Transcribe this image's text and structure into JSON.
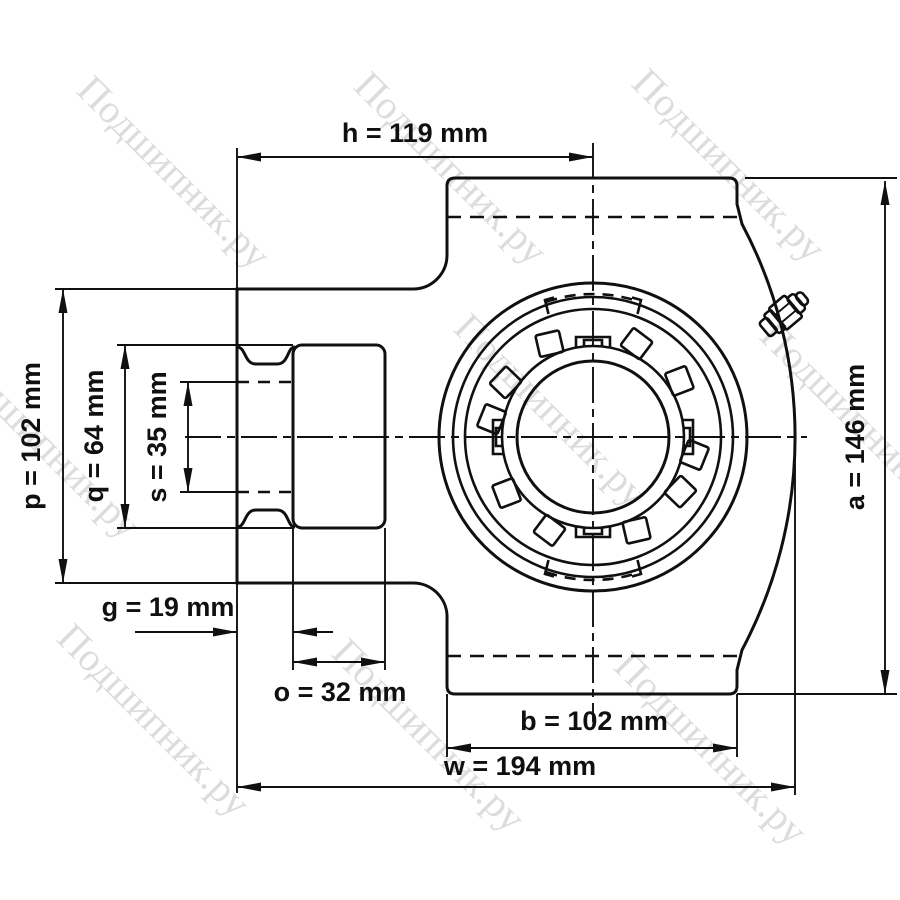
{
  "figure": {
    "watermark": "Подшипник.ру",
    "dims": {
      "h": "h = 119 mm",
      "p": "p = 102 mm",
      "q": "q = 64 mm",
      "s": "s = 35 mm",
      "g": "g = 19 mm",
      "o": "o = 32 mm",
      "b": "b = 102 mm",
      "w": "w = 194 mm",
      "a": "a = 146 mm"
    },
    "colors": {
      "line": "#101010",
      "bore_fill": "#dfdfdf",
      "watermark": "#c5c5c5",
      "background": "#ffffff"
    }
  }
}
